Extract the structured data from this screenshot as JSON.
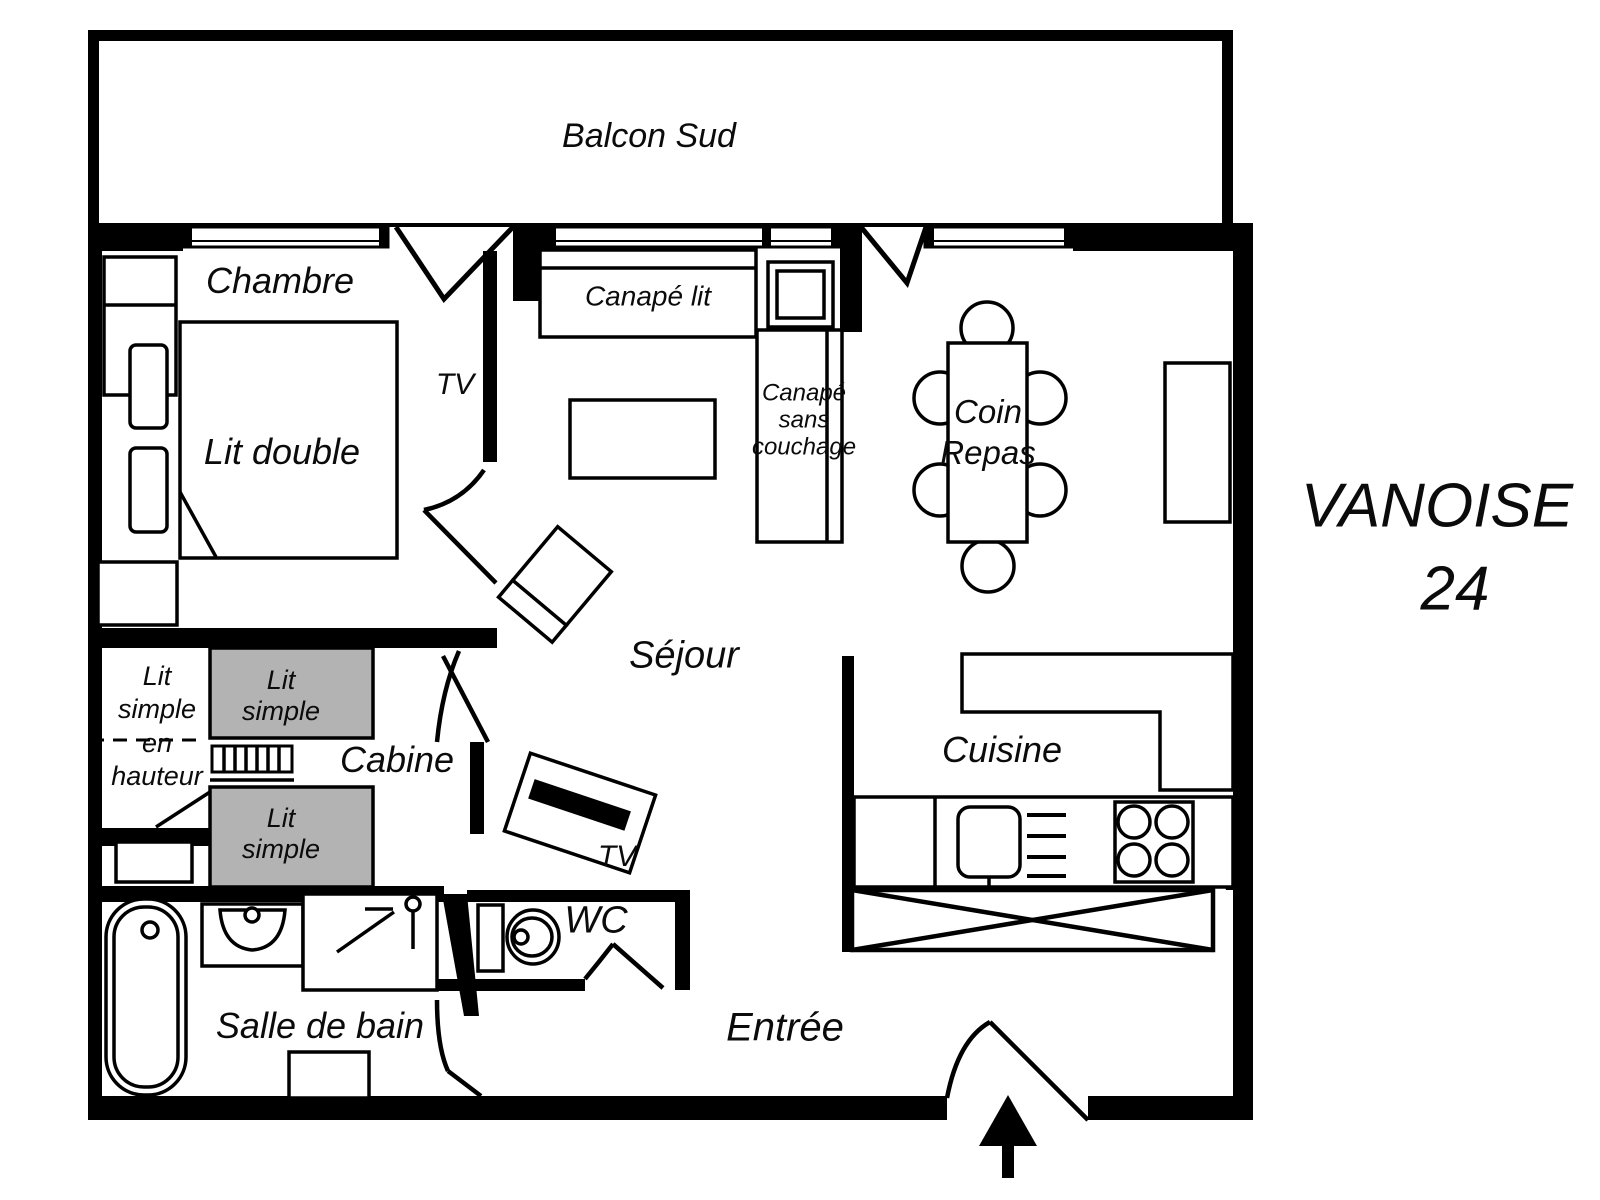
{
  "plan": {
    "title_line1": "VANOISE",
    "title_line2": "24",
    "colors": {
      "wall": "#000000",
      "bed_gray": "#b3b3b3",
      "background": "#ffffff"
    }
  },
  "rooms": {
    "balcony": "Balcon Sud",
    "bedroom": "Chambre",
    "living": "Séjour",
    "cabin": "Cabine",
    "kitchen": "Cuisine",
    "bathroom": "Salle de bain",
    "wc": "WC",
    "entry": "Entrée",
    "dining_line1": "Coin",
    "dining_line2": "Repas"
  },
  "furniture": {
    "double_bed": "Lit double",
    "corridor_tv": "TV",
    "living_tv": "TV",
    "sofa_bed": "Canapé lit",
    "sofa_plain_line1": "Canapé",
    "sofa_plain_line2": "sans",
    "sofa_plain_line3": "couchage",
    "bunk_line1": "Lit",
    "bunk_line2": "simple",
    "bunk_line3": "en",
    "bunk_line4": "hauteur",
    "single_top_line1": "Lit",
    "single_top_line2": "simple",
    "single_bottom_line1": "Lit",
    "single_bottom_line2": "simple"
  }
}
